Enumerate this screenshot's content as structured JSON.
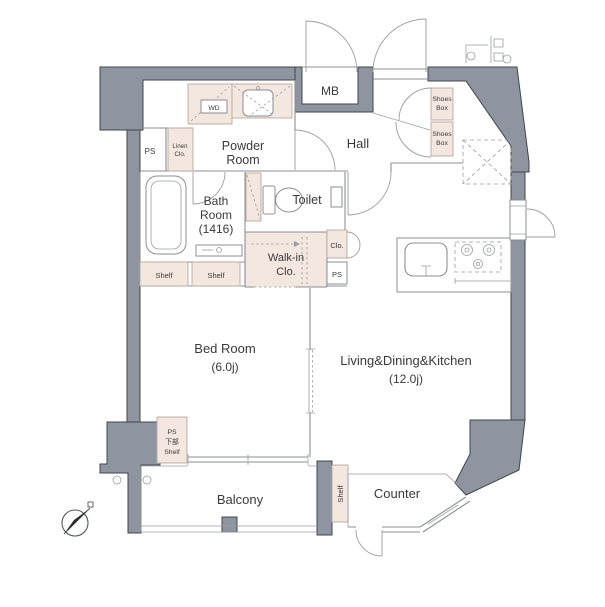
{
  "plan": {
    "rooms": {
      "powder_room": {
        "line1": "Powder",
        "line2": "Room"
      },
      "hall": "Hall",
      "bath_room": {
        "line1": "Bath",
        "line2": "Room",
        "line3": "(1416)"
      },
      "toilet": "Toilet",
      "walk_in_closet": {
        "line1": "Walk-in",
        "line2": "Clo."
      },
      "bed_room": {
        "name": "Bed Room",
        "size": "(6.0j)"
      },
      "ldk": {
        "name": "Living&Dining&Kitchen",
        "size": "(12.0j)"
      },
      "balcony": "Balcony",
      "counter": "Counter"
    },
    "labels": {
      "mb": "MB",
      "wd": "WD",
      "ps": "PS",
      "linen_closet": {
        "line1": "Linen",
        "line2": "Clo."
      },
      "shoes_box": {
        "line1": "Shoes",
        "line2": "Box"
      },
      "closet": "Clo.",
      "shelf": "Shelf",
      "ps_lower_shelf": {
        "line1": "PS",
        "line2": "下部",
        "line3": "Shelf"
      }
    },
    "colors": {
      "wall_fill": "#8e95a1",
      "wall_stroke": "#41454d",
      "storage_fill": "#f4e7df",
      "storage_stroke": "#b9a89f",
      "line": "#8c8f94",
      "text": "#3a3a3a",
      "background": "#ffffff"
    }
  }
}
